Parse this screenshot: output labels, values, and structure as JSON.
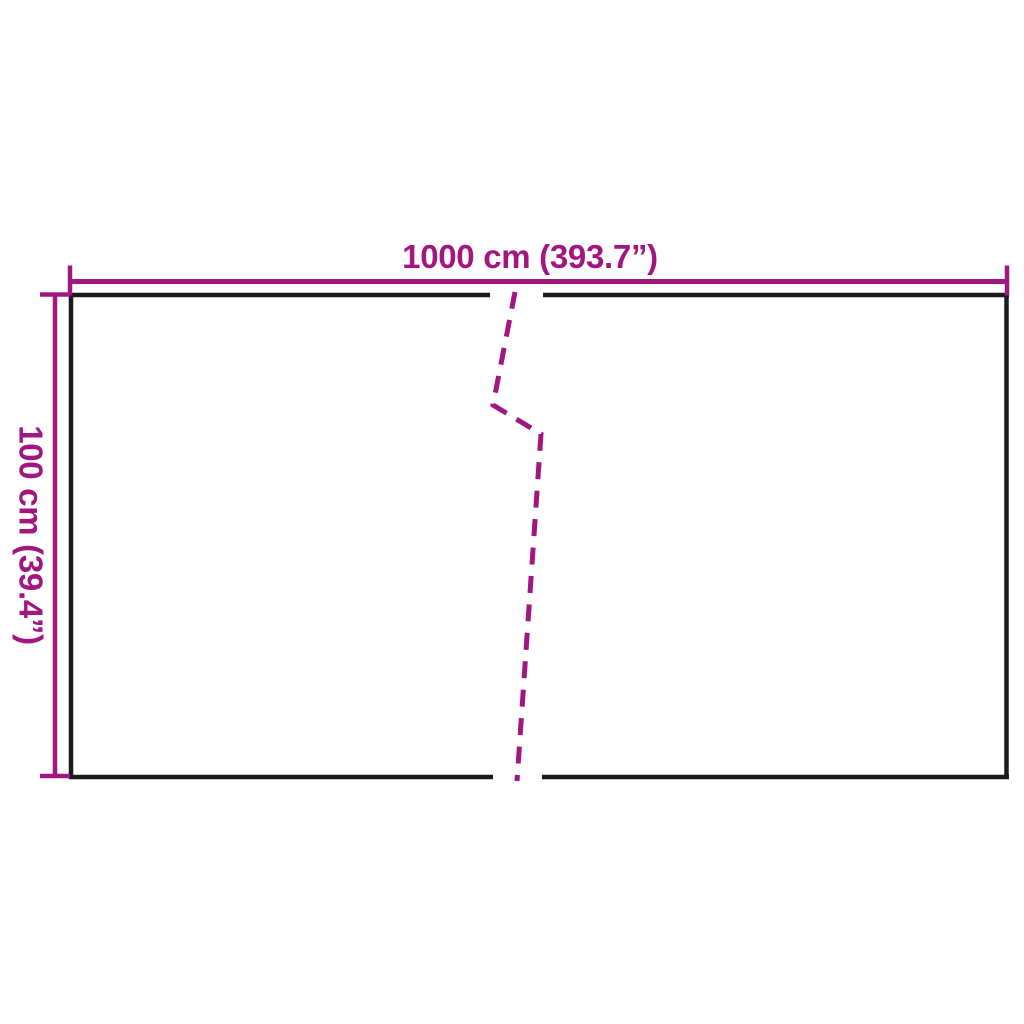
{
  "diagram": {
    "title": "panel-dimension-diagram",
    "width_label": "1000 cm (393.7”)",
    "height_label": "100 cm (39.4”)",
    "colors": {
      "dimension": "#A21680",
      "outline": "#1B1B1B",
      "background": "#FFFFFF"
    }
  }
}
